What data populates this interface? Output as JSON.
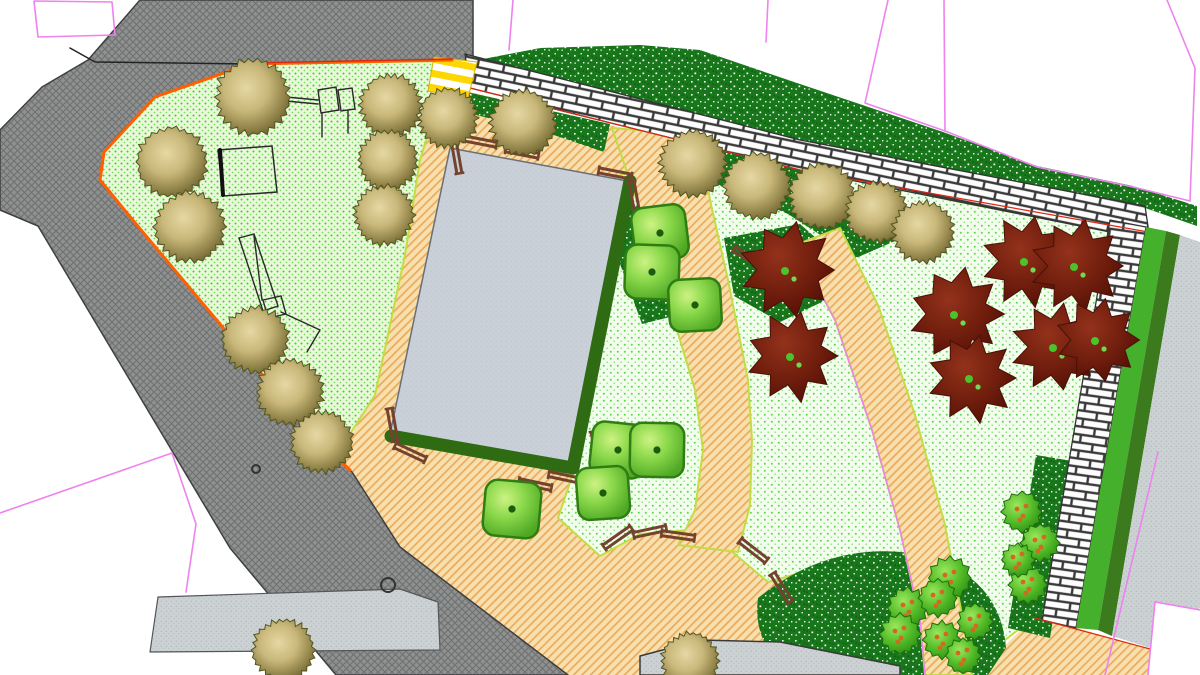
{
  "meta": {
    "kind": "landscape-site-plan",
    "canvas_w": 1200,
    "canvas_h": 675
  },
  "palette": {
    "background": "#ffffff",
    "road_asphalt": "#8f9090",
    "sidewalk": "#ccd2d3",
    "lawn_playground_bg": "#e9f8d9",
    "lawn_dot": "#46cc32",
    "lawn_pale_bg": "#f3fdee",
    "shrub_bed_green": "#18761b",
    "path_sand": "#f8dfae",
    "path_hatch_orange": "#e8a24c",
    "brick_white": "#fdfdfd",
    "brick_joint": "#3a3a3a",
    "building_gray": "#cad0d8",
    "hedge_dark_green": "#2e6b13",
    "strip_bright_green": "#44b02c",
    "strip_olive_green": "#3c7a1e",
    "boundary_orange": "#ff5f00",
    "boundary_red": "#dd2810",
    "parcel_magenta": "#ee82ee",
    "lawn_edge_yellow": "#c3dc46",
    "crosswalk_yellow": "#ffd700",
    "bench_brown": "#74432f",
    "tree_olive_light": "#e6d8a4",
    "tree_olive_dark": "#6d6530",
    "tree_red_dark": "#6f1d0d",
    "tree_red_center_green": "#49c42a",
    "shrub_topiary_green": "#8cd94c",
    "fruit_bush_green": "#53bb28",
    "fruit_dot_orange": "#d2691e",
    "equipment_line": "#2a2a2a"
  },
  "surfaces": {
    "tan_base": [
      [
        436,
        56
      ],
      [
        482,
        63
      ],
      [
        470,
        92
      ],
      [
        800,
        170
      ],
      [
        1150,
        242
      ],
      [
        1110,
        400
      ],
      [
        1062,
        625
      ],
      [
        1035,
        616
      ],
      [
        998,
        645
      ],
      [
        955,
        668
      ],
      [
        900,
        675
      ],
      [
        400,
        675
      ],
      [
        340,
        580
      ],
      [
        330,
        470
      ],
      [
        360,
        420
      ],
      [
        420,
        160
      ]
    ],
    "tan_corner": [
      [
        1035,
        616
      ],
      [
        1150,
        649
      ],
      [
        1200,
        658
      ],
      [
        1200,
        675
      ],
      [
        975,
        675
      ]
    ],
    "road": [
      [
        140,
        0
      ],
      [
        473,
        0
      ],
      [
        473,
        62
      ],
      [
        452,
        60
      ],
      [
        250,
        64
      ],
      [
        155,
        97
      ],
      [
        104,
        152
      ],
      [
        100,
        180
      ],
      [
        136,
        224
      ],
      [
        314,
        436
      ],
      [
        352,
        472
      ],
      [
        400,
        547
      ],
      [
        568,
        675
      ],
      [
        336,
        675
      ],
      [
        230,
        548
      ],
      [
        38,
        226
      ],
      [
        0,
        210
      ],
      [
        0,
        130
      ],
      [
        42,
        87
      ],
      [
        88,
        60
      ]
    ],
    "sidewalk": [
      [
        158,
        597
      ],
      [
        400,
        589
      ],
      [
        438,
        602
      ],
      [
        440,
        650
      ],
      [
        150,
        652
      ]
    ],
    "playground_lawn": [
      [
        250,
        64
      ],
      [
        445,
        61
      ],
      [
        455,
        78
      ],
      [
        440,
        95
      ],
      [
        420,
        160
      ],
      [
        405,
        255
      ],
      [
        375,
        395
      ],
      [
        332,
        462
      ],
      [
        314,
        436
      ],
      [
        136,
        224
      ],
      [
        100,
        180
      ],
      [
        104,
        152
      ],
      [
        155,
        97
      ]
    ],
    "big_lawn": [
      [
        612,
        178
      ],
      [
        700,
        150
      ],
      [
        800,
        162
      ],
      [
        950,
        200
      ],
      [
        1105,
        230
      ],
      [
        1146,
        242
      ],
      [
        1108,
        400
      ],
      [
        1074,
        624
      ],
      [
        1040,
        613
      ],
      [
        1005,
        640
      ],
      [
        975,
        670
      ],
      [
        938,
        672
      ],
      [
        920,
        645
      ],
      [
        868,
        605
      ],
      [
        830,
        588
      ],
      [
        800,
        573
      ],
      [
        768,
        582
      ],
      [
        730,
        550
      ],
      [
        690,
        530
      ],
      [
        640,
        534
      ],
      [
        600,
        556
      ],
      [
        558,
        518
      ],
      [
        576,
        465
      ],
      [
        600,
        330
      ],
      [
        606,
        240
      ]
    ],
    "green_top_strip": [
      [
        478,
        60
      ],
      [
        540,
        48
      ],
      [
        640,
        45
      ],
      [
        700,
        50
      ],
      [
        800,
        84
      ],
      [
        943,
        132
      ],
      [
        1037,
        166
      ],
      [
        1133,
        186
      ],
      [
        1197,
        206
      ],
      [
        1197,
        226
      ],
      [
        1145,
        208
      ],
      [
        800,
        142
      ],
      [
        470,
        72
      ]
    ],
    "shrub_bed_1": [
      [
        440,
        86
      ],
      [
        610,
        124
      ],
      [
        604,
        152
      ],
      [
        545,
        132
      ],
      [
        448,
        108
      ]
    ],
    "shrub_bed_2": [
      [
        700,
        140
      ],
      [
        800,
        167
      ],
      [
        868,
        214
      ],
      [
        902,
        238
      ],
      [
        856,
        258
      ],
      [
        788,
        214
      ],
      [
        712,
        182
      ]
    ],
    "shrub_bed_3": [
      [
        724,
        238
      ],
      [
        800,
        224
      ],
      [
        832,
        252
      ],
      [
        822,
        302
      ],
      [
        780,
        322
      ],
      [
        734,
        296
      ]
    ],
    "shrub_bed_4": [
      [
        616,
        198
      ],
      [
        662,
        214
      ],
      [
        680,
        258
      ],
      [
        674,
        316
      ],
      [
        642,
        324
      ],
      [
        620,
        264
      ]
    ],
    "shrub_crescent_d": "M758,598 Q830,540 918,554 Q1000,574 1006,648 L988,675 L788,675 Q752,640 758,598 Z",
    "shrub_bed_6": [
      [
        1036,
        455
      ],
      [
        1078,
        462
      ],
      [
        1050,
        638
      ],
      [
        1008,
        628
      ]
    ],
    "center_path": [
      [
        612,
        128
      ],
      [
        640,
        210
      ],
      [
        668,
        300
      ],
      [
        695,
        390
      ],
      [
        703,
        450
      ],
      [
        695,
        510
      ],
      [
        678,
        545
      ],
      [
        738,
        552
      ],
      [
        750,
        505
      ],
      [
        752,
        440
      ],
      [
        748,
        380
      ],
      [
        728,
        280
      ],
      [
        710,
        200
      ],
      [
        700,
        135
      ]
    ],
    "arc_path": [
      [
        795,
        245
      ],
      [
        835,
        320
      ],
      [
        872,
        430
      ],
      [
        900,
        530
      ],
      [
        920,
        620
      ],
      [
        925,
        675
      ],
      [
        972,
        675
      ],
      [
        962,
        615
      ],
      [
        945,
        525
      ],
      [
        915,
        415
      ],
      [
        878,
        305
      ],
      [
        840,
        228
      ]
    ],
    "building": [
      [
        450,
        148
      ],
      [
        633,
        182
      ],
      [
        573,
        468
      ],
      [
        390,
        434
      ]
    ],
    "brick_top": [
      [
        465,
        54
      ],
      [
        800,
        140
      ],
      [
        1145,
        206
      ],
      [
        1150,
        240
      ],
      [
        800,
        170
      ],
      [
        470,
        88
      ]
    ],
    "brick_right": [
      [
        1110,
        220
      ],
      [
        1146,
        227
      ],
      [
        1076,
        628
      ],
      [
        1042,
        620
      ]
    ],
    "strip_bright": [
      [
        1146,
        227
      ],
      [
        1166,
        231
      ],
      [
        1098,
        630
      ],
      [
        1076,
        628
      ]
    ],
    "strip_olive": [
      [
        1166,
        231
      ],
      [
        1180,
        235
      ],
      [
        1112,
        636
      ],
      [
        1098,
        630
      ]
    ],
    "gray_paving": [
      [
        1180,
        235
      ],
      [
        1200,
        242
      ],
      [
        1200,
        608
      ],
      [
        1150,
        648
      ],
      [
        1112,
        636
      ]
    ],
    "white_corner": [
      [
        1155,
        602
      ],
      [
        1200,
        610
      ],
      [
        1200,
        675
      ],
      [
        1148,
        675
      ]
    ],
    "bottom_strip": [
      [
        640,
        656
      ],
      [
        700,
        640
      ],
      [
        780,
        642
      ],
      [
        900,
        666
      ],
      [
        900,
        675
      ],
      [
        640,
        675
      ]
    ],
    "yellow_crossing": [
      [
        434,
        57
      ],
      [
        477,
        62
      ],
      [
        468,
        98
      ],
      [
        428,
        91
      ]
    ]
  },
  "lines": {
    "hedge": [
      [
        630,
        181
      ],
      [
        573,
        468
      ],
      [
        391,
        436
      ]
    ],
    "site_boundary_orange": [
      [
        452,
        60
      ],
      [
        250,
        64
      ],
      [
        155,
        97
      ],
      [
        104,
        152
      ],
      [
        100,
        180
      ],
      [
        136,
        224
      ],
      [
        314,
        436
      ],
      [
        350,
        470
      ]
    ],
    "site_boundary_red": [
      [
        452,
        59
      ],
      [
        250,
        63
      ]
    ],
    "curb": [
      [
        70,
        48
      ],
      [
        95,
        62
      ],
      [
        250,
        64
      ]
    ],
    "brick_edge_red": [
      [
        470,
        88
      ],
      [
        800,
        170
      ],
      [
        1148,
        232
      ]
    ],
    "corner_edge_red": [
      [
        1035,
        618
      ],
      [
        1150,
        649
      ]
    ],
    "arc_magenta": [
      [
        795,
        245
      ],
      [
        835,
        320
      ],
      [
        872,
        430
      ],
      [
        900,
        530
      ],
      [
        920,
        620
      ],
      [
        925,
        675
      ]
    ],
    "parcel_closed": [
      [
        34,
        1
      ],
      [
        112,
        2
      ],
      [
        115,
        35
      ],
      [
        38,
        37
      ]
    ],
    "parcel_polylines": [
      [
        [
          513,
          0
        ],
        [
          509,
          50
        ]
      ],
      [
        [
          768,
          0
        ],
        [
          766,
          42
        ]
      ],
      [
        [
          888,
          0
        ],
        [
          865,
          103
        ],
        [
          945,
          131
        ]
      ],
      [
        [
          944,
          0
        ],
        [
          945,
          131
        ]
      ],
      [
        [
          945,
          131
        ],
        [
          1037,
          167
        ],
        [
          1133,
          187
        ],
        [
          1190,
          201
        ],
        [
          1195,
          68
        ],
        [
          1167,
          0
        ]
      ],
      [
        [
          0,
          513
        ],
        [
          172,
          453
        ],
        [
          196,
          524
        ],
        [
          186,
          592
        ]
      ],
      [
        [
          1158,
          452
        ],
        [
          1105,
          675
        ]
      ],
      [
        [
          1155,
          602
        ],
        [
          1200,
          610
        ]
      ],
      [
        [
          1155,
          602
        ],
        [
          1148,
          675
        ]
      ]
    ]
  },
  "trees": {
    "canopy_olive": [
      [
        253,
        97,
        34
      ],
      [
        391,
        105,
        28
      ],
      [
        388,
        160,
        27
      ],
      [
        384,
        215,
        27
      ],
      [
        172,
        162,
        32
      ],
      [
        190,
        227,
        32
      ],
      [
        255,
        340,
        30
      ],
      [
        290,
        392,
        30
      ],
      [
        322,
        442,
        28
      ],
      [
        448,
        118,
        27
      ],
      [
        523,
        123,
        30
      ],
      [
        693,
        163,
        30
      ],
      [
        757,
        186,
        30
      ],
      [
        822,
        196,
        30
      ],
      [
        877,
        212,
        28
      ],
      [
        923,
        232,
        28
      ],
      [
        283,
        650,
        28
      ],
      [
        690,
        661,
        26
      ]
    ],
    "ornamental_red": [
      [
        788,
        270,
        43
      ],
      [
        793,
        356,
        41
      ],
      [
        957,
        314,
        42
      ],
      [
        972,
        378,
        40
      ],
      [
        1027,
        261,
        41
      ],
      [
        1077,
        266,
        42
      ],
      [
        1056,
        347,
        40
      ],
      [
        1098,
        340,
        38
      ]
    ],
    "shrub_topiary": [
      [
        660,
        233,
        27
      ],
      [
        652,
        272,
        27
      ],
      [
        695,
        305,
        26
      ],
      [
        618,
        450,
        27
      ],
      [
        657,
        450,
        27
      ],
      [
        603,
        493,
        26
      ],
      [
        512,
        509,
        28
      ]
    ],
    "fruit_bush": [
      [
        950,
        578,
        18
      ],
      [
        908,
        608,
        17
      ],
      [
        938,
        598,
        16
      ],
      [
        900,
        634,
        17
      ],
      [
        942,
        640,
        16
      ],
      [
        963,
        656,
        15
      ],
      [
        975,
        622,
        15
      ],
      [
        1022,
        512,
        17
      ],
      [
        1040,
        543,
        16
      ],
      [
        1028,
        585,
        16
      ],
      [
        1018,
        560,
        14
      ]
    ]
  },
  "benches": [
    [
      480,
      142,
      11
    ],
    [
      456,
      157,
      80
    ],
    [
      522,
      153,
      11
    ],
    [
      615,
      174,
      11
    ],
    [
      634,
      198,
      80
    ],
    [
      392,
      425,
      80
    ],
    [
      410,
      453,
      25
    ],
    [
      535,
      485,
      12
    ],
    [
      565,
      478,
      12
    ],
    [
      596,
      448,
      80
    ],
    [
      618,
      538,
      -35
    ],
    [
      650,
      532,
      -12
    ],
    [
      678,
      536,
      8
    ],
    [
      748,
      258,
      32
    ],
    [
      753,
      551,
      38
    ],
    [
      781,
      588,
      58
    ]
  ],
  "play_equipment": {
    "swing_rects": [
      [
        [
          318,
          90
        ],
        [
          336,
          87
        ],
        [
          339,
          110
        ],
        [
          321,
          113
        ]
      ],
      [
        [
          338,
          90
        ],
        [
          352,
          88
        ],
        [
          355,
          109
        ],
        [
          341,
          111
        ]
      ]
    ],
    "swing_lines": [
      [
        [
          286,
          97
        ],
        [
          318,
          100
        ]
      ],
      [
        [
          286,
          101
        ],
        [
          318,
          104
        ]
      ],
      [
        [
          322,
          113
        ],
        [
          322,
          137
        ]
      ],
      [
        [
          348,
          111
        ],
        [
          348,
          133
        ]
      ]
    ],
    "sandbox": [
      [
        218,
        150
      ],
      [
        272,
        146
      ],
      [
        277,
        192
      ],
      [
        223,
        196
      ]
    ],
    "sandbox_bar": [
      [
        220,
        150
      ],
      [
        223,
        195
      ]
    ],
    "slide_rect": [
      [
        239,
        238
      ],
      [
        254,
        234
      ],
      [
        278,
        306
      ],
      [
        263,
        311
      ]
    ],
    "slide_square": [
      [
        263,
        300
      ],
      [
        281,
        296
      ],
      [
        286,
        314
      ],
      [
        268,
        318
      ]
    ],
    "slide_lines": [
      [
        [
          281,
          312
        ],
        [
          320,
          330
        ],
        [
          307,
          352
        ]
      ],
      [
        [
          254,
          236
        ],
        [
          262,
          300
        ]
      ]
    ]
  },
  "manholes": [
    [
      388,
      585,
      7
    ],
    [
      256,
      469,
      4
    ]
  ]
}
